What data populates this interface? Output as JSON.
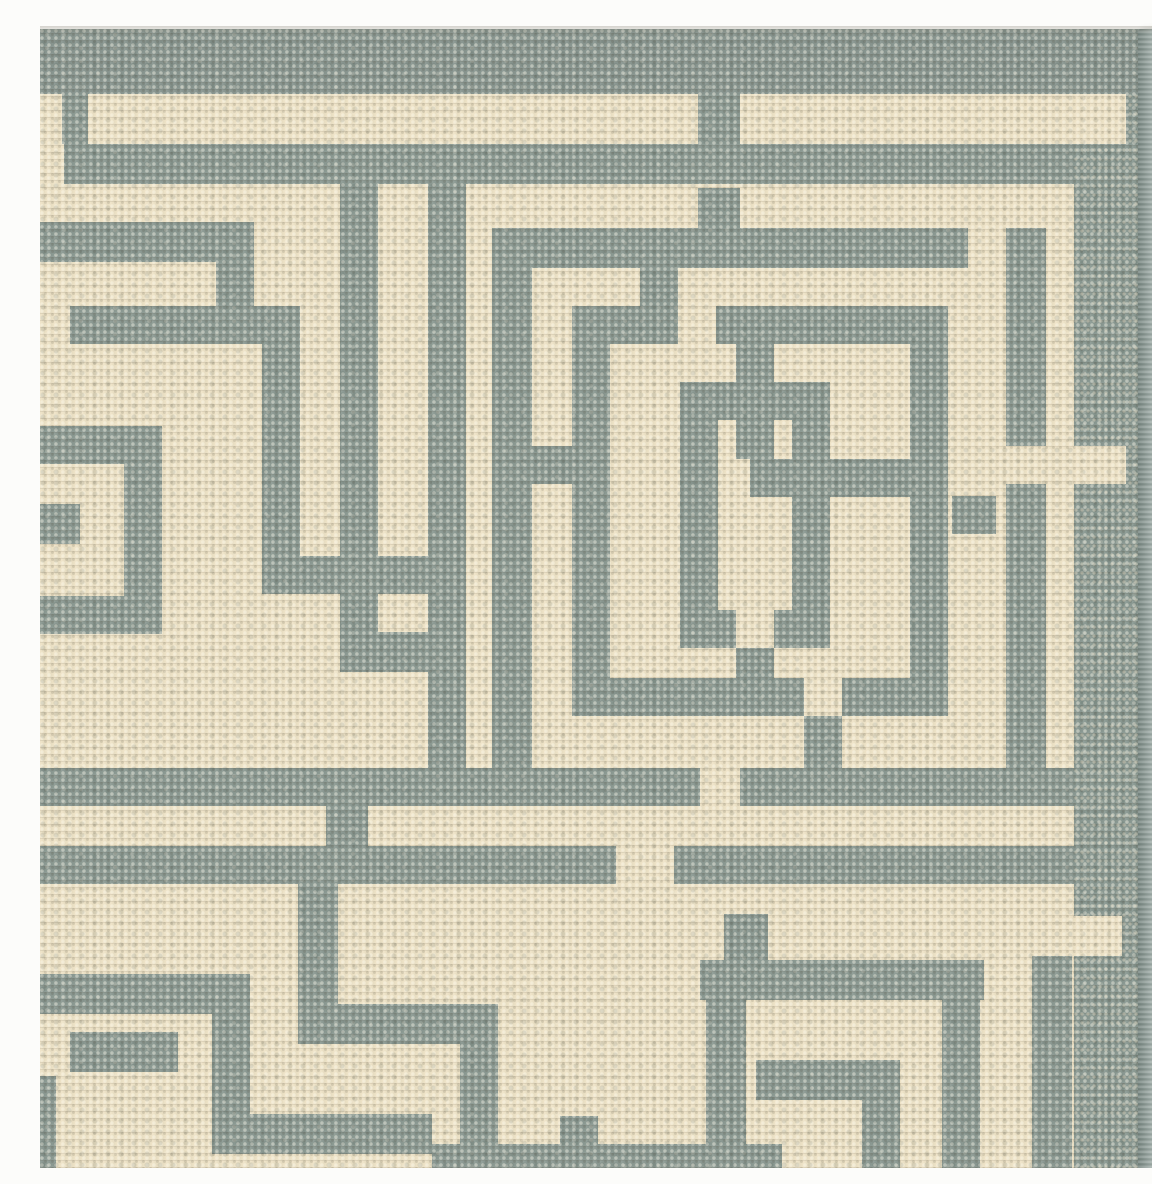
{
  "scene": {
    "subject": "corner of a grey and cream flat-woven rug with interlocking greek-key maze pattern",
    "view": "top-down close-up photograph on white background"
  },
  "palette": {
    "cream": "#eee3c7",
    "cream_hi": "#f8efdb",
    "cream_lo": "#d8c7a3",
    "grey": "#8c9a93",
    "grey_dark": "#59675f",
    "band_grey": "#899690",
    "binding_grey": "#8a9992",
    "serge_grey": "#8d9c97",
    "serge_edge": "#6e7f79",
    "photo_white": "#fcfcfa"
  },
  "canvas": {
    "w": 1152,
    "h": 1152
  },
  "rug": {
    "field": [
      0,
      13,
      1098,
      1139
    ],
    "top_band": [
      0,
      13,
      1136,
      65
    ],
    "binding_block": [
      1034,
      78,
      64,
      1074
    ],
    "serge": [
      1098,
      13,
      38,
      1139
    ],
    "notches": [
      [
        1034,
        78,
        52,
        50
      ],
      [
        1034,
        430,
        52,
        38
      ],
      [
        1034,
        900,
        48,
        40
      ]
    ],
    "photo_background": {
      "top": [
        0,
        0,
        1152,
        13
      ],
      "right": [
        1136,
        0,
        16,
        1152
      ]
    },
    "pattern_groups": [
      {
        "name": "top-frame-lines",
        "rects": [
          [
            24,
            128,
            1010,
            40
          ],
          [
            0,
            206,
            214,
            40
          ],
          [
            176,
            246,
            38,
            44
          ]
        ]
      },
      {
        "name": "top-connectors",
        "rects": [
          [
            22,
            78,
            26,
            50
          ],
          [
            658,
            78,
            42,
            50
          ]
        ]
      },
      {
        "name": "left-key-motif",
        "rects": [
          [
            30,
            290,
            230,
            38
          ],
          [
            222,
            290,
            38,
            288
          ],
          [
            222,
            540,
            170,
            38
          ],
          [
            0,
            410,
            122,
            38
          ],
          [
            84,
            410,
            38,
            208
          ],
          [
            0,
            580,
            122,
            38
          ],
          [
            0,
            488,
            40,
            40
          ],
          [
            300,
            168,
            38,
            448
          ],
          [
            300,
            616,
            126,
            40
          ],
          [
            388,
            168,
            38,
            584
          ]
        ]
      },
      {
        "name": "outer-square",
        "rects": [
          [
            452,
            212,
            476,
            40
          ],
          [
            966,
            212,
            40,
            218
          ],
          [
            966,
            468,
            40,
            322
          ],
          [
            452,
            252,
            40,
            500
          ]
        ]
      },
      {
        "name": "inner-square",
        "rects": [
          [
            532,
            290,
            106,
            38
          ],
          [
            676,
            290,
            232,
            38
          ],
          [
            600,
            250,
            38,
            40
          ],
          [
            532,
            290,
            38,
            410
          ],
          [
            870,
            290,
            38,
            410
          ],
          [
            532,
            662,
            232,
            38
          ],
          [
            802,
            662,
            106,
            38
          ],
          [
            764,
            700,
            38,
            52
          ]
        ]
      },
      {
        "name": "center-interlock",
        "rects": [
          [
            640,
            366,
            56,
            38
          ],
          [
            734,
            366,
            56,
            38
          ],
          [
            640,
            366,
            38,
            266
          ],
          [
            752,
            366,
            38,
            77
          ],
          [
            752,
            481,
            38,
            151
          ],
          [
            640,
            594,
            56,
            38
          ],
          [
            734,
            594,
            56,
            38
          ],
          [
            696,
            328,
            38,
            115
          ],
          [
            696,
            632,
            38,
            30
          ],
          [
            710,
            443,
            160,
            38
          ]
        ]
      },
      {
        "name": "channel-dashes",
        "rects": [
          [
            658,
            172,
            42,
            40
          ],
          [
            492,
            430,
            40,
            38
          ],
          [
            912,
            480,
            44,
            38
          ]
        ]
      },
      {
        "name": "lower-frame-lines",
        "rects": [
          [
            0,
            752,
            660,
            38
          ],
          [
            700,
            752,
            334,
            38
          ],
          [
            286,
            790,
            42,
            40
          ],
          [
            0,
            830,
            576,
            38
          ],
          [
            634,
            830,
            400,
            38
          ],
          [
            684,
            898,
            44,
            46
          ]
        ]
      },
      {
        "name": "bottom-left-key",
        "rects": [
          [
            0,
            958,
            210,
            40
          ],
          [
            172,
            998,
            38,
            100
          ],
          [
            172,
            1098,
            220,
            40
          ],
          [
            30,
            1016,
            108,
            40
          ],
          [
            0,
            1060,
            16,
            92
          ],
          [
            258,
            868,
            40,
            160
          ],
          [
            258,
            988,
            200,
            40
          ],
          [
            420,
            1028,
            38,
            124
          ],
          [
            520,
            1100,
            38,
            52
          ]
        ]
      },
      {
        "name": "bottom-right-corner",
        "rects": [
          [
            660,
            944,
            284,
            40
          ],
          [
            902,
            984,
            38,
            168
          ],
          [
            716,
            1044,
            144,
            40
          ],
          [
            822,
            1084,
            38,
            68
          ],
          [
            666,
            984,
            40,
            144
          ],
          [
            392,
            1128,
            350,
            24
          ],
          [
            992,
            940,
            40,
            212
          ]
        ]
      }
    ]
  }
}
